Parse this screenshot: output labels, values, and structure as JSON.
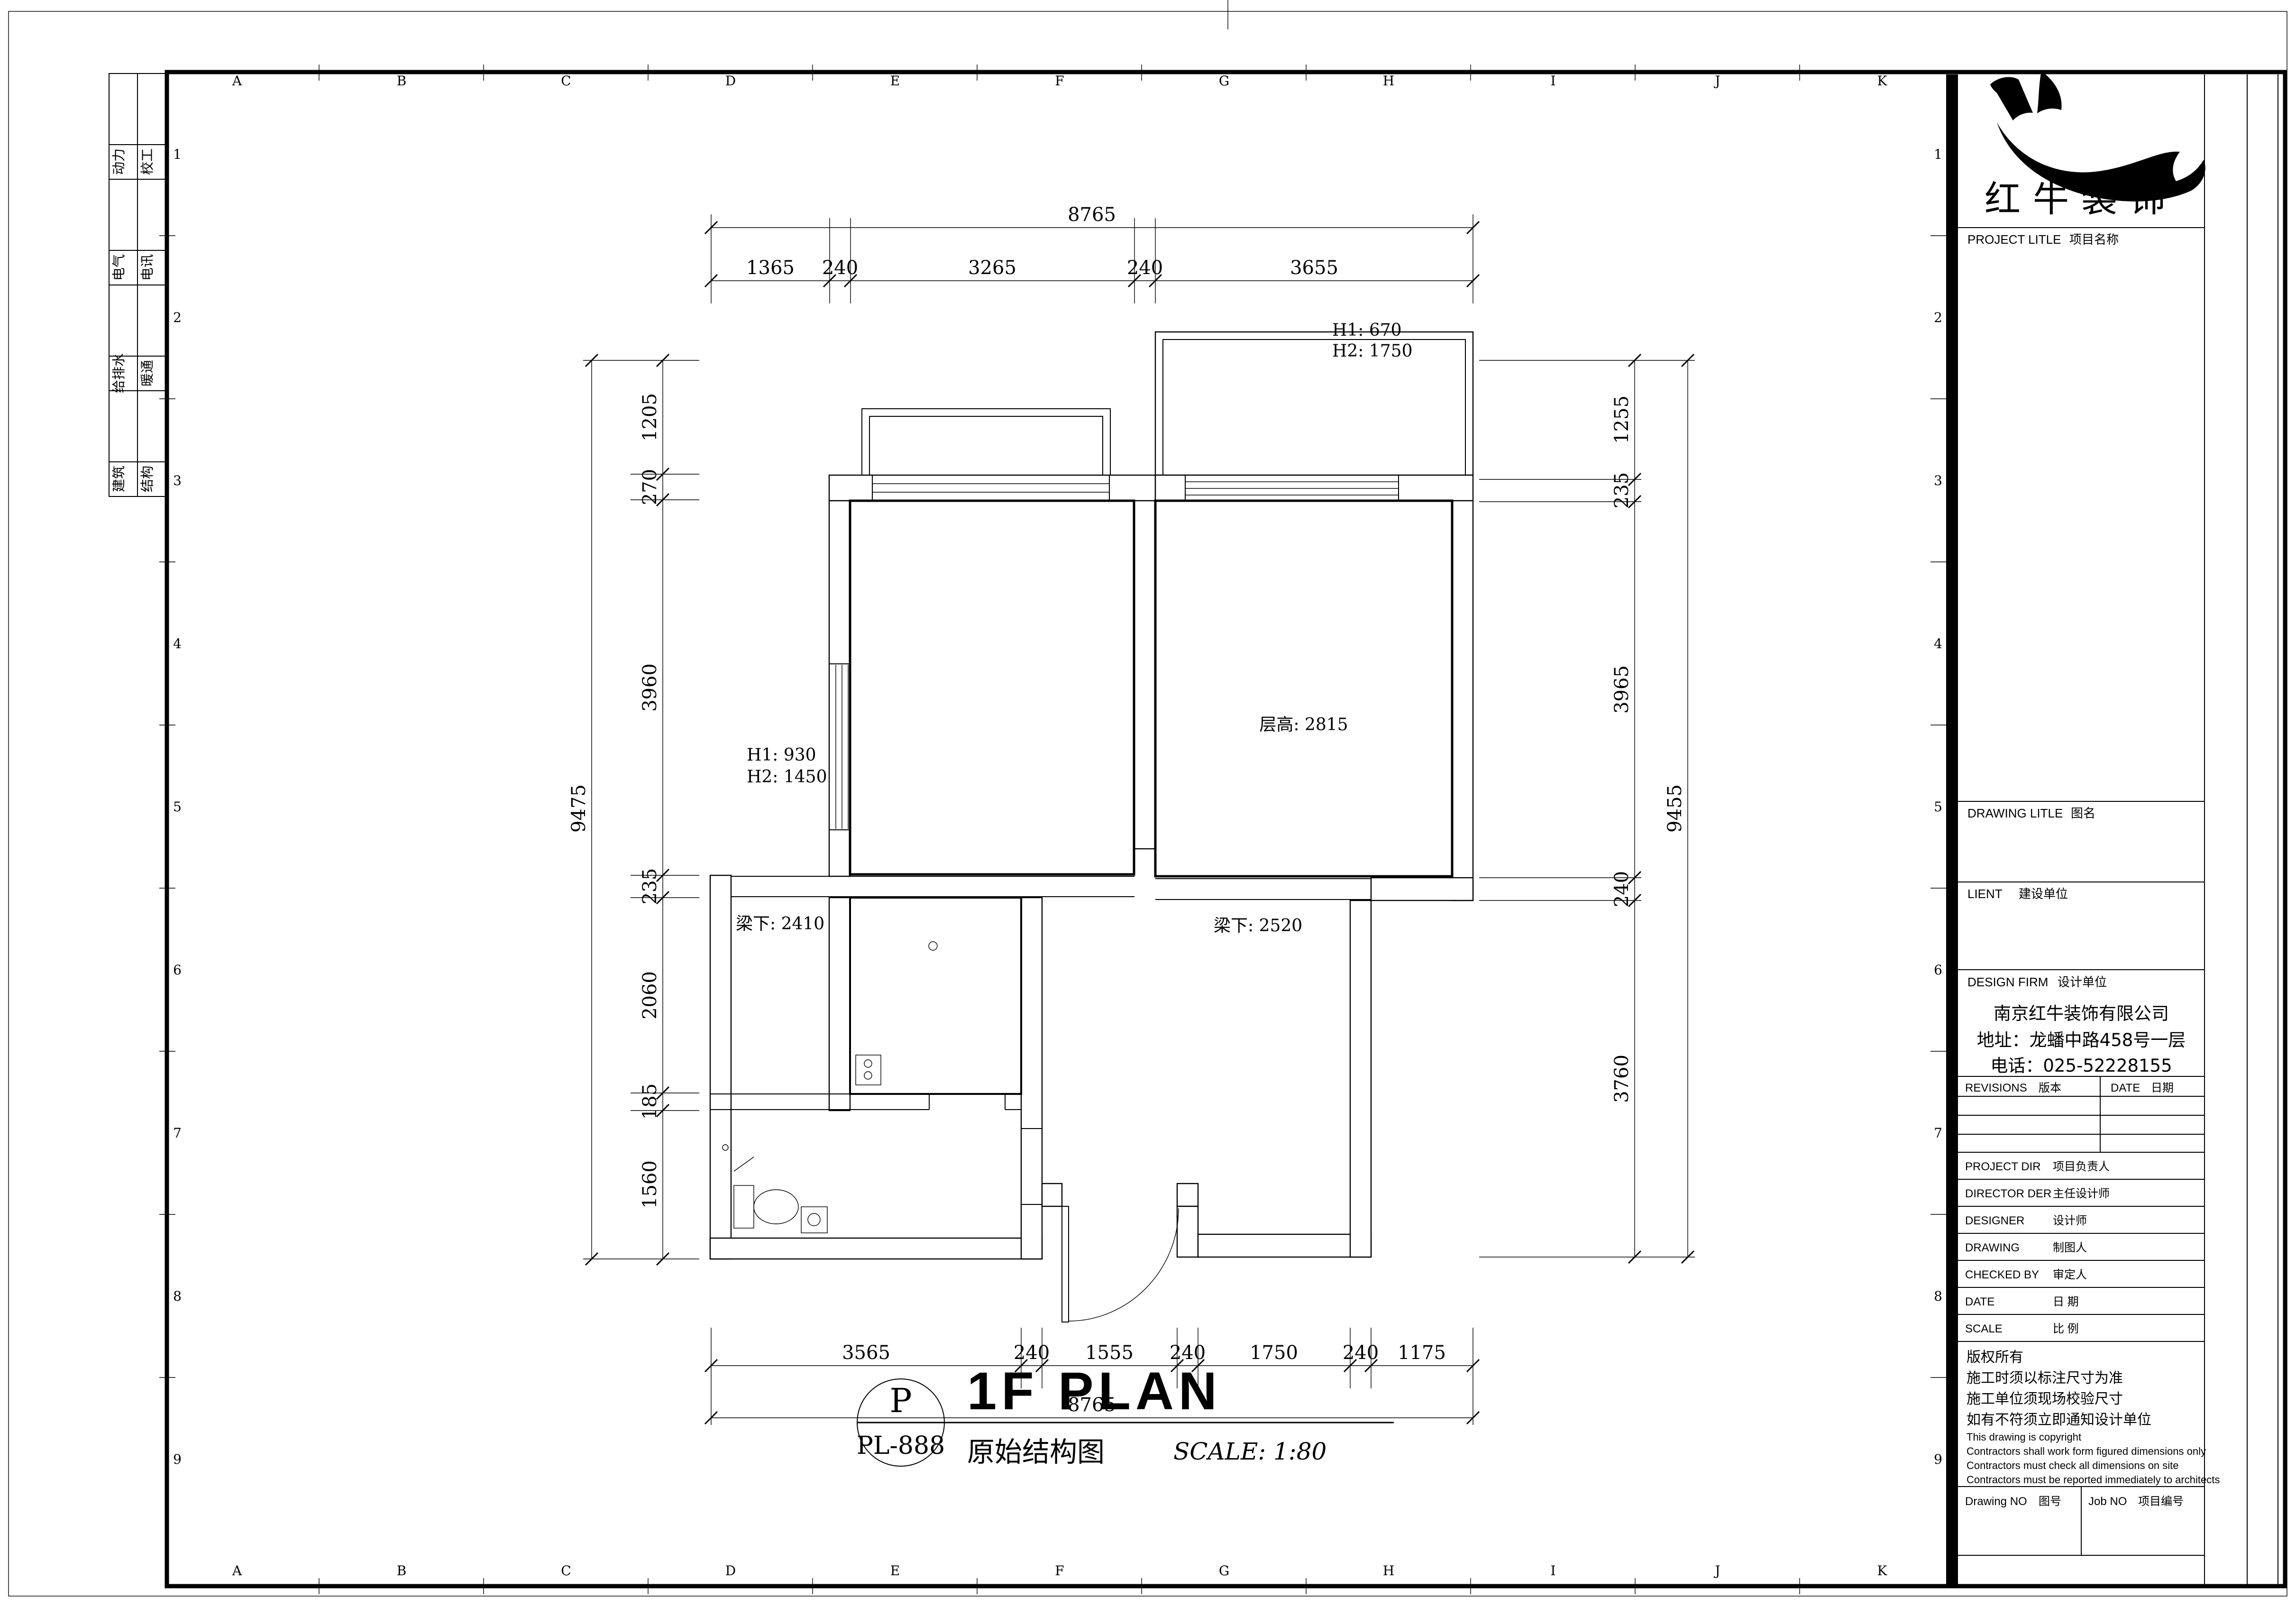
{
  "colors": {
    "ink": "#000000",
    "paper": "#ffffff"
  },
  "sheet": {
    "grid": {
      "letters": [
        "A",
        "B",
        "C",
        "D",
        "E",
        "F",
        "G",
        "H",
        "I",
        "J",
        "K"
      ],
      "numbers": [
        "1",
        "2",
        "3",
        "4",
        "5",
        "6",
        "7",
        "8",
        "9"
      ]
    },
    "tabs": [
      {
        "c1": "动力",
        "c2": "校工"
      },
      {
        "c1": "电气",
        "c2": "电讯"
      },
      {
        "c1": "给排水",
        "c2": "暖通"
      },
      {
        "c1": "建筑",
        "c2": "结构"
      }
    ]
  },
  "plan": {
    "annotations": {
      "win_top_h1": "H1: 670",
      "win_top_h2": "H2: 1750",
      "win_left_h1": "H1: 930",
      "win_left_h2": "H2: 1450",
      "ceiling_height": "层高: 2815",
      "beam_left": "梁下: 2410",
      "beam_right": "梁下: 2520"
    },
    "dims": {
      "top": {
        "overall": "8765",
        "segments": [
          "1365",
          "240",
          "3265",
          "240",
          "3655"
        ]
      },
      "bottom": {
        "overall": "8765",
        "segments": [
          "3565",
          "240",
          "1555",
          "240",
          "1750",
          "240",
          "1175"
        ]
      },
      "left": {
        "overall": "9475",
        "segments": [
          "1205",
          "270",
          "3960",
          "235",
          "2060",
          "185",
          "1560"
        ]
      },
      "right": {
        "overall": "9455",
        "segments": [
          "1255",
          "235",
          "3965",
          "240",
          "3760"
        ]
      }
    }
  },
  "title": {
    "code_top": "P",
    "code_bottom": "PL-888",
    "name_en": "1F PLAN",
    "name_cn": "原始结构图",
    "scale": "SCALE: 1:80"
  },
  "title_block": {
    "logo_text": "红牛装饰",
    "project_title_en": "PROJECT LITLE",
    "project_title_cn": "项目名称",
    "drawing_title_en": "DRAWING LITLE",
    "drawing_title_cn": "图名",
    "client_en": "LIENT",
    "client_cn": "建设单位",
    "design_firm_en": "DESIGN FIRM",
    "design_firm_cn": "设计单位",
    "firm": [
      "南京红牛装饰有限公司",
      "地址：龙蟠中路458号一层",
      "电话：025-52228155"
    ],
    "revisions_en": "REVISIONS",
    "revisions_cn": "版本",
    "date_col_en": "DATE",
    "date_col_cn": "日期",
    "rows": [
      {
        "en": "PROJECT DIR",
        "cn": "项目负责人"
      },
      {
        "en": "DIRECTOR DER",
        "cn": "主任设计师"
      },
      {
        "en": "DESIGNER",
        "cn": "设计师"
      },
      {
        "en": "DRAWING",
        "cn": "制图人"
      },
      {
        "en": "CHECKED BY",
        "cn": "审定人"
      },
      {
        "en": "DATE",
        "cn": "日  期"
      },
      {
        "en": "SCALE",
        "cn": "比  例"
      }
    ],
    "copyright": [
      "版权所有",
      "施工时须以标注尺寸为准",
      "施工单位须现场校验尺寸",
      "如有不符须立即通知设计单位",
      "This drawing is copyright",
      "Contractors shall work form figured dimensions only",
      "Contractors must check all dimensions on site",
      "Contractors must be reported immediately to architects"
    ],
    "drawing_no_en": "Drawing NO",
    "drawing_no_cn": "图号",
    "job_no_en": "Job NO",
    "job_no_cn": "项目编号"
  }
}
